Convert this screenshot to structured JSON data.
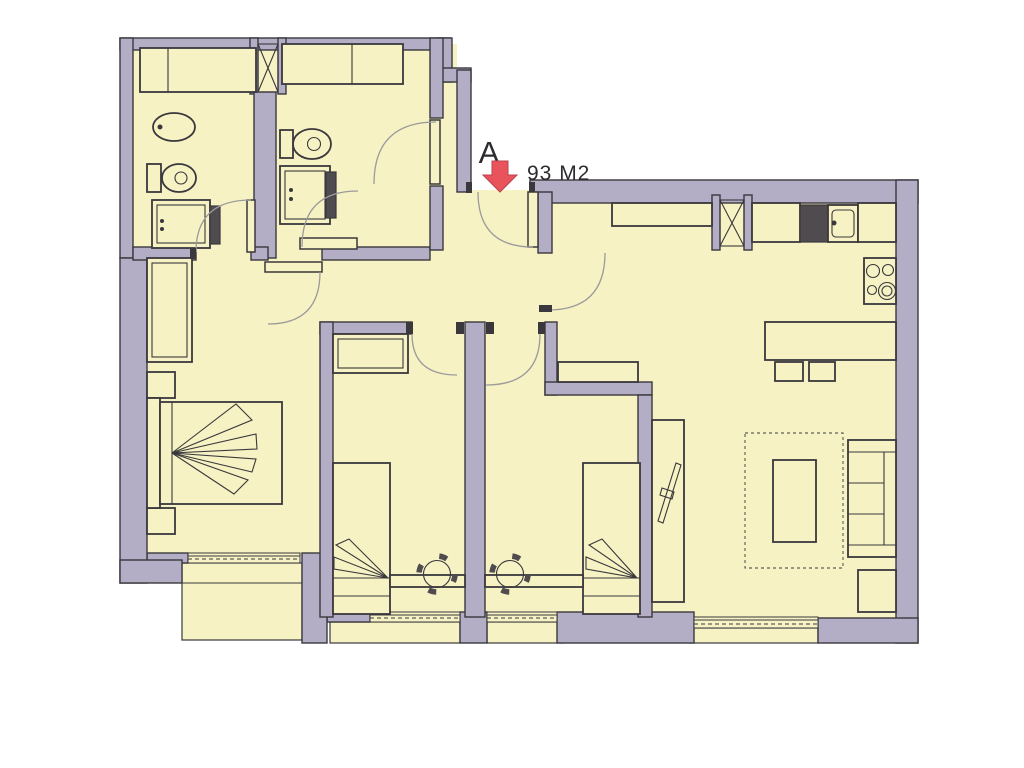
{
  "marker": {
    "unit_label": "A",
    "area_label": "93 M2"
  },
  "colors": {
    "background": "#ffffff",
    "room_fill": "#f6f2c3",
    "wall_fill": "#b4adc6",
    "line": "#3a383c",
    "arc": "#9b9b9b",
    "dark_fixture": "#4f4b4f",
    "accent": "#e9545c",
    "text_color": "#2d2b30"
  }
}
